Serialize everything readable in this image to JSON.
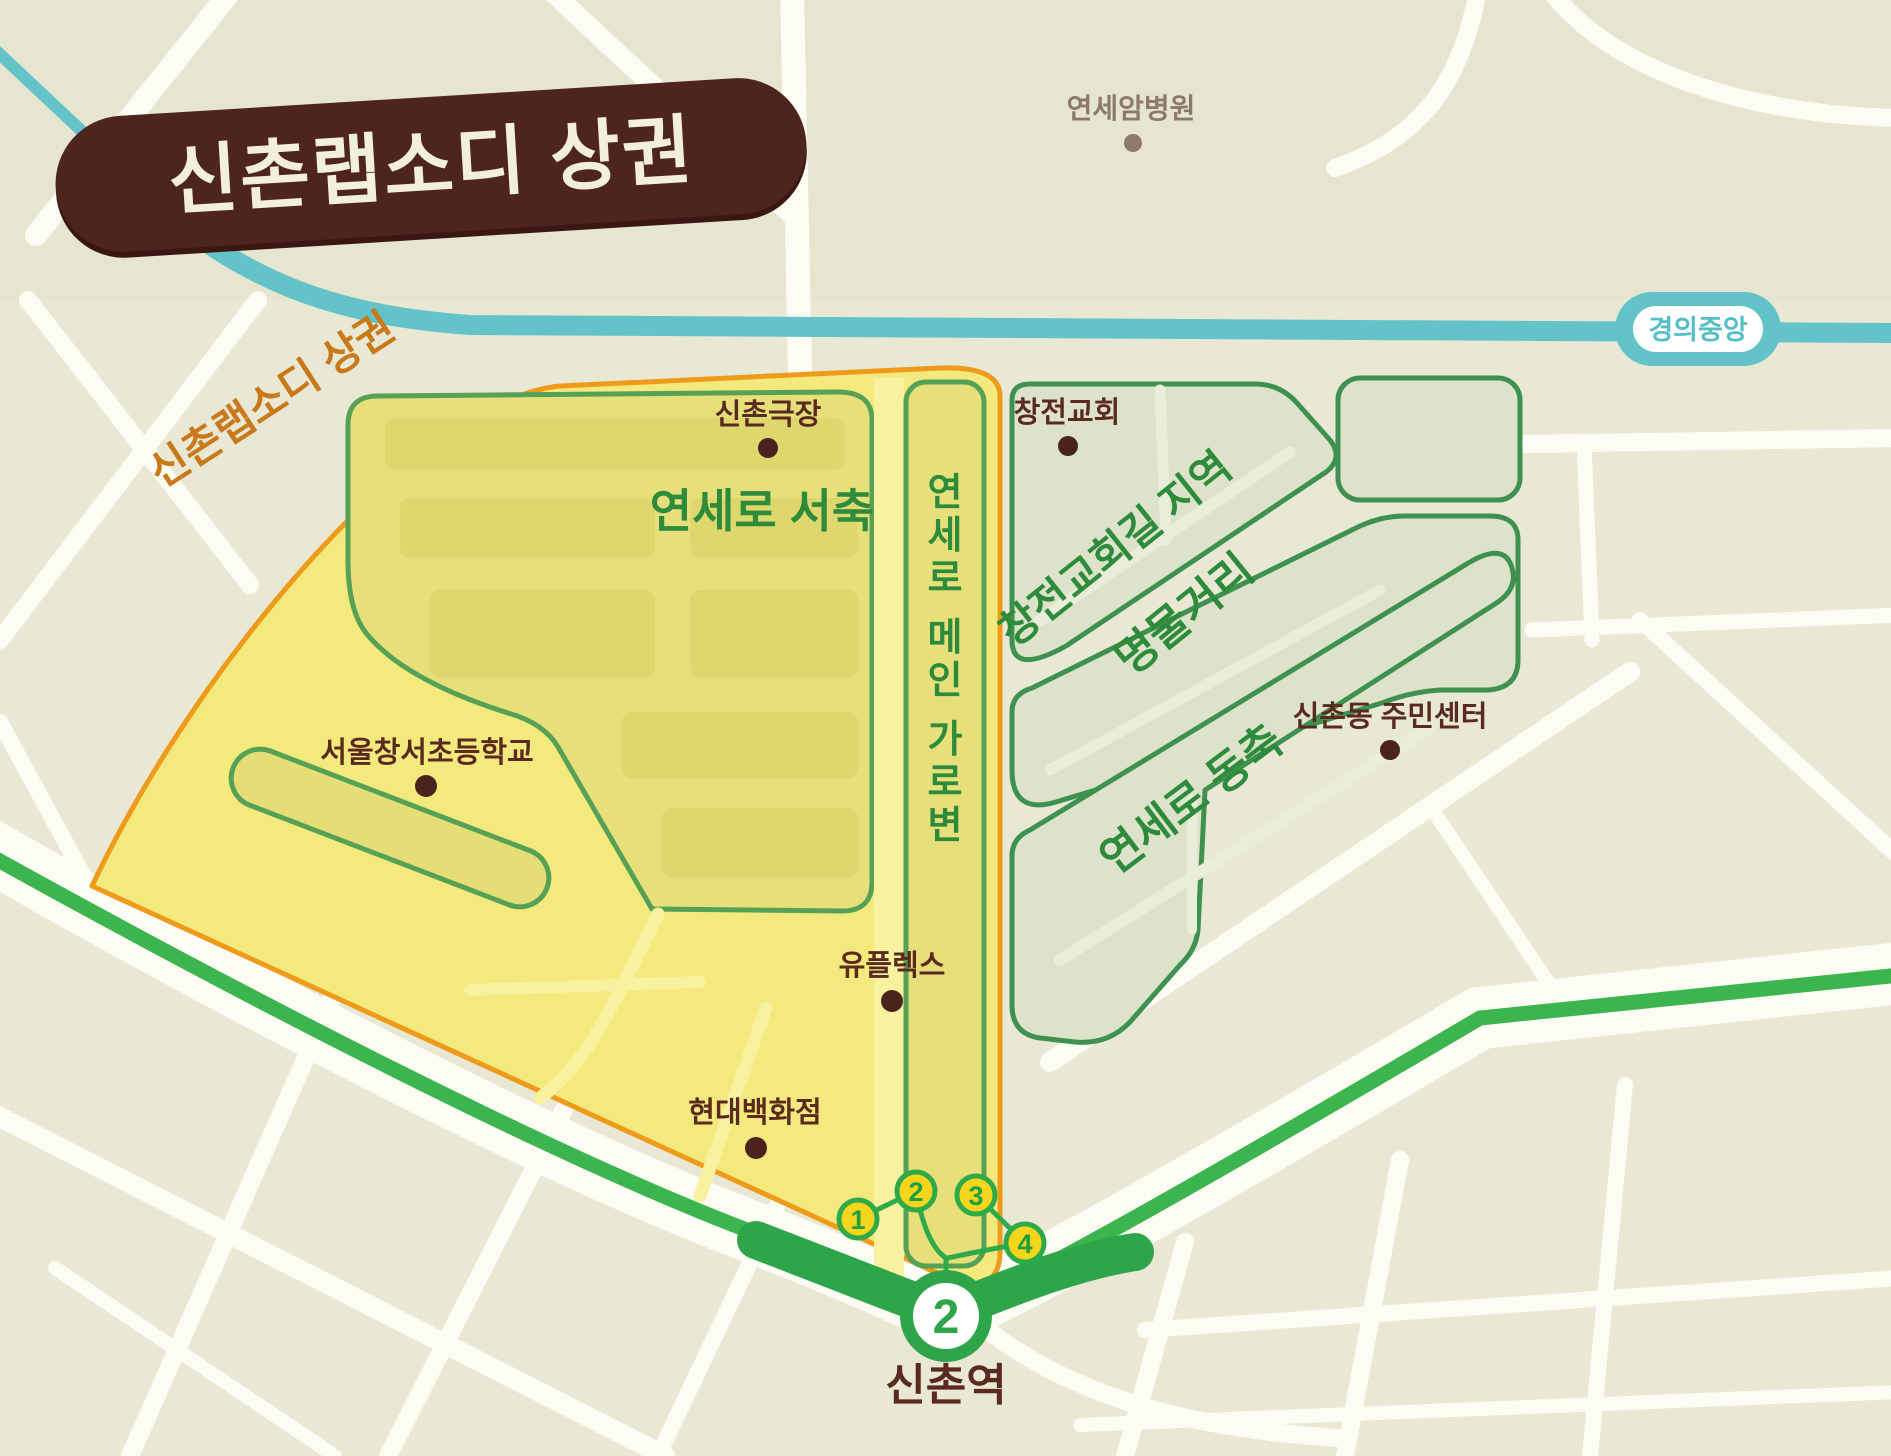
{
  "title": {
    "badge_label": "신촌랩소디 상권"
  },
  "map": {
    "district_label": "신촌랩소디 상권",
    "zones": {
      "west": "연세로 서축",
      "main_street": "연세로 메인 가로변",
      "changcheon": "창전교회길 지역",
      "myeongmul": "명물거리",
      "east": "연세로 동축"
    },
    "pois": {
      "hospital": "연세암병원",
      "theater": "신촌극장",
      "church": "창전교회",
      "school": "서울창서초등학교",
      "community_center": "신촌동 주민센터",
      "uplex": "유플렉스",
      "hyundai": "현대백화점"
    },
    "transit": {
      "gyeongui_line": "경의중앙",
      "station": "신촌역",
      "line_number": "2",
      "exits": [
        "1",
        "2",
        "3",
        "4"
      ]
    },
    "colors": {
      "badge": "#4e241e",
      "badge_text": "#f2efdc",
      "district_text": "#c9781a",
      "zone_yellow": "#f4e97c",
      "zone_yellow_border": "#ee9b1c",
      "subzone_fill": "#e7e07a",
      "subzone_border": "#56a156",
      "band_fill": "#dde3ca",
      "band_border": "#3f9150",
      "band_text": "#2e8b3b",
      "line2_green": "#3cb54e",
      "teal": "#63c3c9",
      "exit_fill": "#f6d51d",
      "exit_border": "#2faa4a",
      "poi_text": "#5a2a1e",
      "hospital_text": "#8d7a6d"
    }
  }
}
